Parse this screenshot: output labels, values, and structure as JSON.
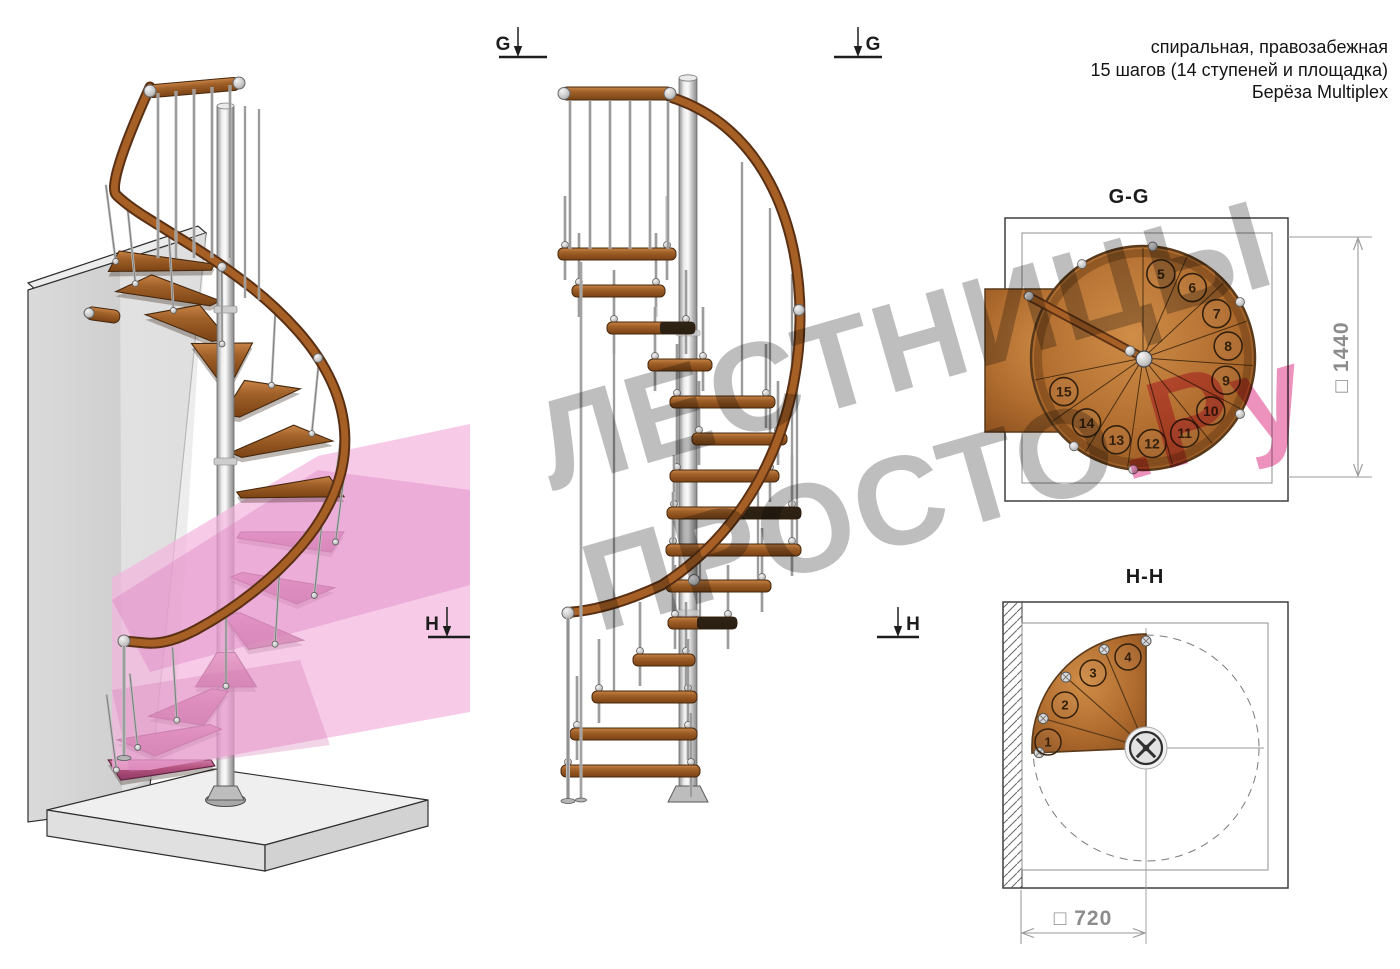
{
  "header": {
    "line1": "спиральная, правозабежная",
    "line2": "15 шагов (14 ступеней и площадка)",
    "line3": "Берёза Multiplex"
  },
  "watermark": {
    "line1": "ЛЕСТНИЦЫ",
    "line2_gray": "ПРОСТО",
    "line2_pink": ".Ру"
  },
  "markers": {
    "g": "G",
    "h": "H"
  },
  "plan_gg": {
    "title": "G-G",
    "dimension": "□ 1440",
    "steps": [
      "5",
      "6",
      "7",
      "8",
      "9",
      "10",
      "11",
      "12",
      "13",
      "14",
      "15"
    ]
  },
  "plan_hh": {
    "title": "H-H",
    "dimension": "□ 720",
    "steps": [
      "1",
      "2",
      "3",
      "4"
    ]
  },
  "colors": {
    "wood": "#a2622a",
    "wood_light": "#c98447",
    "wood_dark": "#46280e",
    "metal": "#c9c9c9",
    "metal_dark": "#6f6f6f",
    "magenta_step": "#b3527e",
    "magenta_dark": "#5e2040",
    "pink_plane": "#f3b4de",
    "watermark_gray": "#9a9a9a",
    "watermark_pink": "#e2448c",
    "ink": "#1a1a1a",
    "dim_gray": "#8c8c8c"
  }
}
